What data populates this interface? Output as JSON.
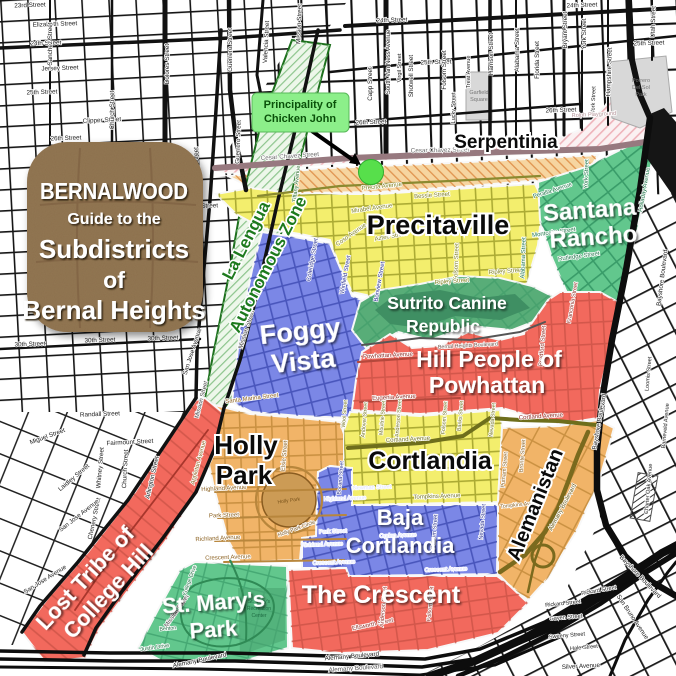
{
  "title_card": {
    "lines": [
      "BERNALWOOD",
      "Guide to the",
      "Subdistricts",
      "of",
      "Bernal Heights"
    ],
    "color": "#8d6f4e"
  },
  "callout": {
    "lines": [
      "Principality of",
      "Chicken John"
    ],
    "bg": "#8cef8a",
    "text_color": "#0a520a"
  },
  "colors": {
    "dot": "#57df4b",
    "cesar_chavez": "#97797f",
    "serpentinia_fill": "#fbf1f2",
    "precita_dmz": "#f6d5a0"
  },
  "districts": {
    "la_lengua": {
      "name": "La Lengua Autonomous Zone",
      "lines": [
        "La Lengua",
        "Autonomous Zone"
      ],
      "color": "#edf7ea"
    },
    "serpentinia": {
      "name": "Serpentinia",
      "color": "#fbf1f2"
    },
    "precitaville": {
      "name": "Precitaville",
      "color": "#f3ee6d"
    },
    "santana_rancho": {
      "name": "Santana Rancho",
      "lines": [
        "Santana",
        "Rancho"
      ],
      "color": "#62c78d"
    },
    "foggy_vista": {
      "name": "Foggy Vista",
      "lines": [
        "Foggy",
        "Vista"
      ],
      "color": "#7b87e6"
    },
    "sutrito": {
      "name": "Sutrito Canine Republic",
      "lines": [
        "Sutrito Canine",
        "Republic"
      ],
      "color": "#58ad78"
    },
    "hill_people": {
      "name": "Hill People of Powhattan",
      "lines": [
        "Hill People of",
        "Powhattan"
      ],
      "color": "#f2695d"
    },
    "holly_park": {
      "name": "Holly Park",
      "lines": [
        "Holly",
        "Park"
      ],
      "color": "#f1b468"
    },
    "cortlandia": {
      "name": "Cortlandia",
      "color": "#f3ee6d"
    },
    "baja_cortlandia": {
      "name": "Baja Cortlandia",
      "lines": [
        "Baja",
        "Cortlandia"
      ],
      "color": "#7b87e6"
    },
    "alemanistan": {
      "name": "Alemanistan",
      "color": "#f1b468"
    },
    "the_crescent": {
      "name": "The Crescent",
      "color": "#f2695d"
    },
    "lost_tribe": {
      "name": "Lost Tribe of College Hill",
      "lines": [
        "Lost Tribe of",
        "College Hill"
      ],
      "color": "#f2695d"
    },
    "st_marys": {
      "name": "St. Mary's Park",
      "lines": [
        "St. Mary's",
        "Park"
      ],
      "color": "#62c78d"
    }
  },
  "parks": {
    "garfield": [
      "Garfield",
      "Square"
    ],
    "potrero": [
      "Potrero",
      "Del Sol",
      "Park"
    ],
    "holly": "Holly Park",
    "bernal": "Bernal Hill Park",
    "st_marys_rec": [
      "St. Mary's",
      "Recreation",
      "Center"
    ]
  },
  "street_labels": [
    {
      "t": "23rd Street",
      "x": 30,
      "y": 7,
      "r": -2
    },
    {
      "t": "Elizabeth Street",
      "x": 55,
      "y": 26,
      "r": -2
    },
    {
      "t": "24th Street",
      "x": 46,
      "y": 45,
      "r": -2
    },
    {
      "t": "24th Street",
      "x": 392,
      "y": 22,
      "r": -2
    },
    {
      "t": "24th Street",
      "x": 582,
      "y": 7,
      "r": -2
    },
    {
      "t": "Jersey Street",
      "x": 60,
      "y": 70,
      "r": -2
    },
    {
      "t": "25th Street",
      "x": 42,
      "y": 94,
      "r": -2
    },
    {
      "t": "25th Street",
      "x": 436,
      "y": 64,
      "r": -2
    },
    {
      "t": "25th Street",
      "x": 649,
      "y": 45,
      "r": -2
    },
    {
      "t": "Clipper Street",
      "x": 102,
      "y": 122,
      "r": -3
    },
    {
      "t": "26th Street",
      "x": 66,
      "y": 140,
      "r": -2
    },
    {
      "t": "26th Street",
      "x": 371,
      "y": 124,
      "r": -2
    },
    {
      "t": "26th Street",
      "x": 561,
      "y": 112,
      "r": -2
    },
    {
      "t": "Duncan Street",
      "x": 198,
      "y": 208,
      "r": -2
    },
    {
      "t": "30th Street",
      "x": 30,
      "y": 346,
      "r": -2
    },
    {
      "t": "30th Street",
      "x": 100,
      "y": 342,
      "r": -2
    },
    {
      "t": "30th Street",
      "x": 163,
      "y": 340,
      "r": -2
    },
    {
      "t": "Randall Street",
      "x": 100,
      "y": 416,
      "r": -2
    },
    {
      "t": "Fairmount Street",
      "x": 130,
      "y": 444,
      "r": -3
    },
    {
      "t": "Miguel Street",
      "x": 48,
      "y": 438,
      "r": -20
    },
    {
      "t": "Laidley Street",
      "x": 75,
      "y": 479,
      "r": -40
    },
    {
      "t": "Whitney Street",
      "x": 102,
      "y": 468,
      "r": -85
    },
    {
      "t": "Church Street",
      "x": 127,
      "y": 469,
      "r": -87
    },
    {
      "t": "Chenery Street",
      "x": 96,
      "y": 519,
      "r": -78
    },
    {
      "t": "Arlington Street",
      "x": 154,
      "y": 478,
      "r": -77
    },
    {
      "t": "San Jose Avenue",
      "x": 80,
      "y": 517,
      "r": -38
    },
    {
      "t": "San Jose Avenue",
      "x": 46,
      "y": 581,
      "r": -32
    },
    {
      "t": "San Jose Avenue",
      "x": 194,
      "y": 352,
      "r": -72
    },
    {
      "t": "Sanchez Street",
      "x": 52,
      "y": 44,
      "r": -90
    },
    {
      "t": "Church Street",
      "x": 114,
      "y": 110,
      "r": -90
    },
    {
      "t": "Dolores Street",
      "x": 169,
      "y": 64,
      "r": -90
    },
    {
      "t": "Fair Oaks Street",
      "x": 198,
      "y": 170,
      "r": -90
    },
    {
      "t": "Guerrero Street",
      "x": 232,
      "y": 50,
      "r": -90
    },
    {
      "t": "Guerrero Street",
      "x": 240,
      "y": 142,
      "r": -88
    },
    {
      "t": "Valencia Street",
      "x": 268,
      "y": 42,
      "r": -87
    },
    {
      "t": "Mission Street",
      "x": 301,
      "y": 24,
      "r": -88
    },
    {
      "t": "Tiffany Avenue",
      "x": 298,
      "y": 184,
      "r": -84,
      "s": 5.6,
      "c": "#2a6b2a"
    },
    {
      "t": "Mission Street",
      "x": 248,
      "y": 330,
      "r": -73,
      "c": "#333333"
    },
    {
      "t": "South Van Ness Avenue",
      "x": 390,
      "y": 62,
      "r": -90,
      "s": 6
    },
    {
      "t": "Capp Street",
      "x": 372,
      "y": 84,
      "r": -90
    },
    {
      "t": "Virgil Street",
      "x": 401,
      "y": 68,
      "r": -90,
      "s": 5.6
    },
    {
      "t": "Shotwell Street",
      "x": 413,
      "y": 76,
      "r": -90
    },
    {
      "t": "Folsom Street",
      "x": 446,
      "y": 70,
      "r": -90
    },
    {
      "t": "Lucky Street",
      "x": 455,
      "y": 108,
      "r": -90,
      "s": 5.6
    },
    {
      "t": "Treat Avenue",
      "x": 470,
      "y": 72,
      "r": -90,
      "s": 5.6
    },
    {
      "t": "Harrison Street",
      "x": 493,
      "y": 54,
      "r": -90
    },
    {
      "t": "Alabama Street",
      "x": 519,
      "y": 50,
      "r": -90
    },
    {
      "t": "Florida Street",
      "x": 539,
      "y": 60,
      "r": -90
    },
    {
      "t": "Bryant Street",
      "x": 567,
      "y": 30,
      "r": -90
    },
    {
      "t": "York Street",
      "x": 586,
      "y": 34,
      "r": -90
    },
    {
      "t": "York Street",
      "x": 595,
      "y": 100,
      "r": -88,
      "s": 5.6
    },
    {
      "t": "Hampshire Street",
      "x": 611,
      "y": 72,
      "r": -88
    },
    {
      "t": "Utah Street",
      "x": 655,
      "y": 22,
      "r": -88
    },
    {
      "t": "Cesar Chavez Street",
      "x": 290,
      "y": 158,
      "r": -4,
      "c": "#6b6b6b"
    },
    {
      "t": "Cesar Chavez Street",
      "x": 440,
      "y": 152,
      "r": -1,
      "c": "#6b6b6b"
    },
    {
      "t": "Rolph Playground",
      "x": 594,
      "y": 116,
      "r": -3,
      "s": 5.6,
      "c": "#b39297"
    },
    {
      "t": "Precita Avenue",
      "x": 382,
      "y": 188,
      "r": -6,
      "s": 6,
      "c": "#80801e"
    },
    {
      "t": "Bessie Street",
      "x": 432,
      "y": 197,
      "r": -4,
      "s": 6,
      "c": "#80801e"
    },
    {
      "t": "Mirabel Avenue",
      "x": 372,
      "y": 210,
      "r": -8,
      "s": 6,
      "c": "#80801e"
    },
    {
      "t": "Coso Avenue",
      "x": 352,
      "y": 236,
      "r": -35,
      "s": 6,
      "c": "#80801e"
    },
    {
      "t": "Aztec Street",
      "x": 391,
      "y": 238,
      "r": -10,
      "s": 6,
      "c": "#80801e"
    },
    {
      "t": "Folsom Street",
      "x": 458,
      "y": 262,
      "r": -88,
      "s": 6,
      "c": "#80801e"
    },
    {
      "t": "Ripley Street",
      "x": 506,
      "y": 273,
      "r": -4,
      "s": 6,
      "c": "#80801e"
    },
    {
      "t": "Ripley Street",
      "x": 452,
      "y": 283,
      "r": -4,
      "s": 6,
      "c": "#80801e"
    },
    {
      "t": "Montcalm Street",
      "x": 554,
      "y": 234,
      "r": -8,
      "s": 6,
      "c": "#1e7448"
    },
    {
      "t": "Rutledge Street",
      "x": 579,
      "y": 258,
      "r": -8,
      "s": 6,
      "c": "#1e7448"
    },
    {
      "t": "Peralta Avenue",
      "x": 553,
      "y": 192,
      "r": -18,
      "s": 6,
      "c": "#1e7448"
    },
    {
      "t": "Alabama Street",
      "x": 525,
      "y": 258,
      "r": -88,
      "s": 6,
      "c": "#1e7448"
    },
    {
      "t": "Holladay Avenue",
      "x": 646,
      "y": 190,
      "r": -80,
      "s": 6,
      "c": "#1e7448"
    },
    {
      "t": "York Street",
      "x": 588,
      "y": 174,
      "r": -88,
      "s": 6,
      "c": "#1e7448"
    },
    {
      "t": "Coleridge Street",
      "x": 314,
      "y": 260,
      "r": -80,
      "s": 6,
      "c": "#28308f"
    },
    {
      "t": "Winfield Street",
      "x": 347,
      "y": 275,
      "r": -80,
      "s": 6,
      "c": "#28308f"
    },
    {
      "t": "Bonview Street",
      "x": 381,
      "y": 282,
      "r": -80,
      "s": 6,
      "c": "#28308f"
    },
    {
      "t": "Mission Street",
      "x": 203,
      "y": 400,
      "r": -76,
      "s": 6,
      "c": "#444444"
    },
    {
      "t": "Mission Street",
      "x": 178,
      "y": 612,
      "r": -55,
      "s": 6,
      "c": "#444444"
    },
    {
      "t": "Powhattan Avenue",
      "x": 388,
      "y": 357,
      "r": -3,
      "s": 6,
      "c": "#8f2b22"
    },
    {
      "t": "Eugenia Avenue",
      "x": 394,
      "y": 399,
      "r": -3,
      "s": 6,
      "c": "#8f2b22"
    },
    {
      "t": "Cortland Avenue",
      "x": 541,
      "y": 418,
      "r": -4,
      "s": 6,
      "c": "#8f2b22"
    },
    {
      "t": "Bradford Street",
      "x": 544,
      "y": 346,
      "r": -85,
      "s": 6,
      "c": "#8f2b22"
    },
    {
      "t": "Franconia Street",
      "x": 574,
      "y": 303,
      "r": -80,
      "s": 5.6,
      "c": "#8f2b22"
    },
    {
      "t": "Bernal Heights Boulevard",
      "x": 468,
      "y": 347,
      "r": -3,
      "s": 5.3,
      "c": "#6a4a42"
    },
    {
      "t": "Cortland Avenue",
      "x": 408,
      "y": 441,
      "r": -3,
      "s": 6,
      "c": "#73731f"
    },
    {
      "t": "Tompkins Avenue",
      "x": 437,
      "y": 498,
      "r": -2,
      "s": 6,
      "c": "#73731f"
    },
    {
      "t": "Wool Street",
      "x": 346,
      "y": 414,
      "r": -85,
      "s": 5.3,
      "c": "#73731f"
    },
    {
      "t": "Andover Street",
      "x": 366,
      "y": 420,
      "r": -85,
      "s": 5.3,
      "c": "#73731f"
    },
    {
      "t": "Moultrie Street",
      "x": 384,
      "y": 418,
      "r": -85,
      "s": 5.3,
      "c": "#73731f"
    },
    {
      "t": "Anderson Street",
      "x": 400,
      "y": 418,
      "r": -85,
      "s": 5.3,
      "c": "#73731f"
    },
    {
      "t": "Folsom Street",
      "x": 446,
      "y": 418,
      "r": -85,
      "s": 5.3,
      "c": "#73731f"
    },
    {
      "t": "Banks Street",
      "x": 462,
      "y": 416,
      "r": -85,
      "s": 5.3,
      "c": "#73731f"
    },
    {
      "t": "Nevada Street",
      "x": 494,
      "y": 420,
      "r": -85,
      "s": 5.3,
      "c": "#73731f"
    },
    {
      "t": "Santa Marina Street",
      "x": 252,
      "y": 400,
      "r": -7,
      "s": 6,
      "c": "#8a5f1e"
    },
    {
      "t": "Appleton Avenue",
      "x": 200,
      "y": 463,
      "r": -75,
      "s": 6,
      "c": "#8a5f1e"
    },
    {
      "t": "Elsie Street",
      "x": 286,
      "y": 456,
      "r": -85,
      "s": 6,
      "c": "#8a5f1e"
    },
    {
      "t": "Highland Avenue",
      "x": 224,
      "y": 490,
      "r": -3,
      "s": 6,
      "c": "#8a5f1e"
    },
    {
      "t": "Park Street",
      "x": 224,
      "y": 517,
      "r": -2,
      "s": 6,
      "c": "#8a5f1e"
    },
    {
      "t": "Richland Avenue",
      "x": 218,
      "y": 540,
      "r": -3,
      "s": 6,
      "c": "#8a5f1e"
    },
    {
      "t": "Crescent Avenue",
      "x": 228,
      "y": 559,
      "r": -2,
      "s": 6,
      "c": "#8a5f1e"
    },
    {
      "t": "Holly Park Circle",
      "x": 297,
      "y": 530,
      "r": -20,
      "s": 5.3,
      "c": "#7a541c"
    },
    {
      "t": "Bocana Street",
      "x": 342,
      "y": 478,
      "r": -85,
      "s": 5.3,
      "c": "#28308f"
    },
    {
      "t": "Highland Avenue",
      "x": 345,
      "y": 500,
      "r": -2,
      "s": 5.6,
      "c": "#dfe3ff"
    },
    {
      "t": "Park Street",
      "x": 333,
      "y": 533,
      "r": -2,
      "s": 5.6,
      "c": "#dfe3ff"
    },
    {
      "t": "Richland Avenue",
      "x": 322,
      "y": 546,
      "r": -2,
      "s": 5.6,
      "c": "#dfe3ff"
    },
    {
      "t": "Crescent Avenue",
      "x": 334,
      "y": 564,
      "r": -2,
      "s": 5.6,
      "c": "#dfe3ff"
    },
    {
      "t": "Crescent Avenue",
      "x": 446,
      "y": 571,
      "r": -2,
      "s": 5.6,
      "c": "#dfe3ff"
    },
    {
      "t": "Ogden Avenue",
      "x": 398,
      "y": 537,
      "r": -2,
      "s": 5.6,
      "c": "#dfe3ff"
    },
    {
      "t": "Newman Street",
      "x": 372,
      "y": 489,
      "r": -2,
      "s": 5.6,
      "c": "#dfe3ff"
    },
    {
      "t": "Folsom Street",
      "x": 436,
      "y": 532,
      "r": -85,
      "s": 5.6,
      "c": "#28308f"
    },
    {
      "t": "Nevada Street",
      "x": 484,
      "y": 522,
      "r": -85,
      "s": 5.6,
      "c": "#28308f"
    },
    {
      "t": "Putnam Street",
      "x": 506,
      "y": 470,
      "r": -85,
      "s": 5.6,
      "c": "#8a5f1e"
    },
    {
      "t": "Bronte Street",
      "x": 524,
      "y": 456,
      "r": -85,
      "s": 5.6,
      "c": "#8a5f1e"
    },
    {
      "t": "Tompkins Avenue",
      "x": 521,
      "y": 506,
      "r": -6,
      "s": 5.3,
      "c": "#8a5f1e"
    },
    {
      "t": "Ellsworth Street",
      "x": 373,
      "y": 626,
      "r": -12,
      "s": 6,
      "c": "#8f2b22"
    },
    {
      "t": "Anderson Street",
      "x": 385,
      "y": 607,
      "r": -85,
      "s": 5.6,
      "c": "#8f2b22"
    },
    {
      "t": "Folsom Street",
      "x": 432,
      "y": 604,
      "r": -85,
      "s": 5.6,
      "c": "#8f2b22"
    },
    {
      "t": "Alemany Boulevard",
      "x": 200,
      "y": 662,
      "r": -12,
      "c": "#222222"
    },
    {
      "t": "Alemany Boulevard",
      "x": 352,
      "y": 658,
      "r": -5,
      "c": "#222222"
    },
    {
      "t": "Alemany Boulevard",
      "x": 356,
      "y": 670,
      "r": -4,
      "c": "#555555"
    },
    {
      "t": "Alemany Boulevard",
      "x": 564,
      "y": 508,
      "r": -62,
      "s": 6,
      "c": "#6b5b18"
    },
    {
      "t": "Bayshore Boulevard",
      "x": 664,
      "y": 278,
      "r": -83
    },
    {
      "t": "Bayshore Boulevard",
      "x": 601,
      "y": 422,
      "r": -80
    },
    {
      "t": "Bayshore Boulevard",
      "x": 639,
      "y": 578,
      "r": 46
    },
    {
      "t": "San Bruno Avenue",
      "x": 631,
      "y": 618,
      "r": 56
    },
    {
      "t": "Silver Avenue",
      "x": 581,
      "y": 668,
      "r": -3
    },
    {
      "t": "Rickard Street",
      "x": 563,
      "y": 605,
      "r": -6,
      "s": 5.6
    },
    {
      "t": "Rickard Street",
      "x": 599,
      "y": 592,
      "r": -10,
      "s": 5.6
    },
    {
      "t": "Gaven Street",
      "x": 566,
      "y": 619,
      "r": -5,
      "s": 5.6
    },
    {
      "t": "Sweeny Street",
      "x": 567,
      "y": 637,
      "r": -5,
      "s": 5.6
    },
    {
      "t": "Hale Street",
      "x": 584,
      "y": 649,
      "r": -5,
      "s": 5.6
    },
    {
      "t": "Loomis Street",
      "x": 650,
      "y": 374,
      "r": -85,
      "s": 5.6
    },
    {
      "t": "Barneveld Avenue",
      "x": 667,
      "y": 426,
      "r": -85,
      "s": 5.6
    },
    {
      "t": "Charter Oak Avenue",
      "x": 650,
      "y": 489,
      "r": -85,
      "s": 5.6
    },
    {
      "t": "Justin Drive",
      "x": 155,
      "y": 649,
      "r": -8,
      "s": 5.6,
      "c": "#1d6b40"
    },
    {
      "t": "College Drive",
      "x": 191,
      "y": 581,
      "r": -70,
      "s": 5.3,
      "c": "#1d6b40"
    },
    {
      "t": "Benton",
      "x": 168,
      "y": 630,
      "r": -5,
      "s": 5.3,
      "c": "#1d6b40"
    }
  ]
}
